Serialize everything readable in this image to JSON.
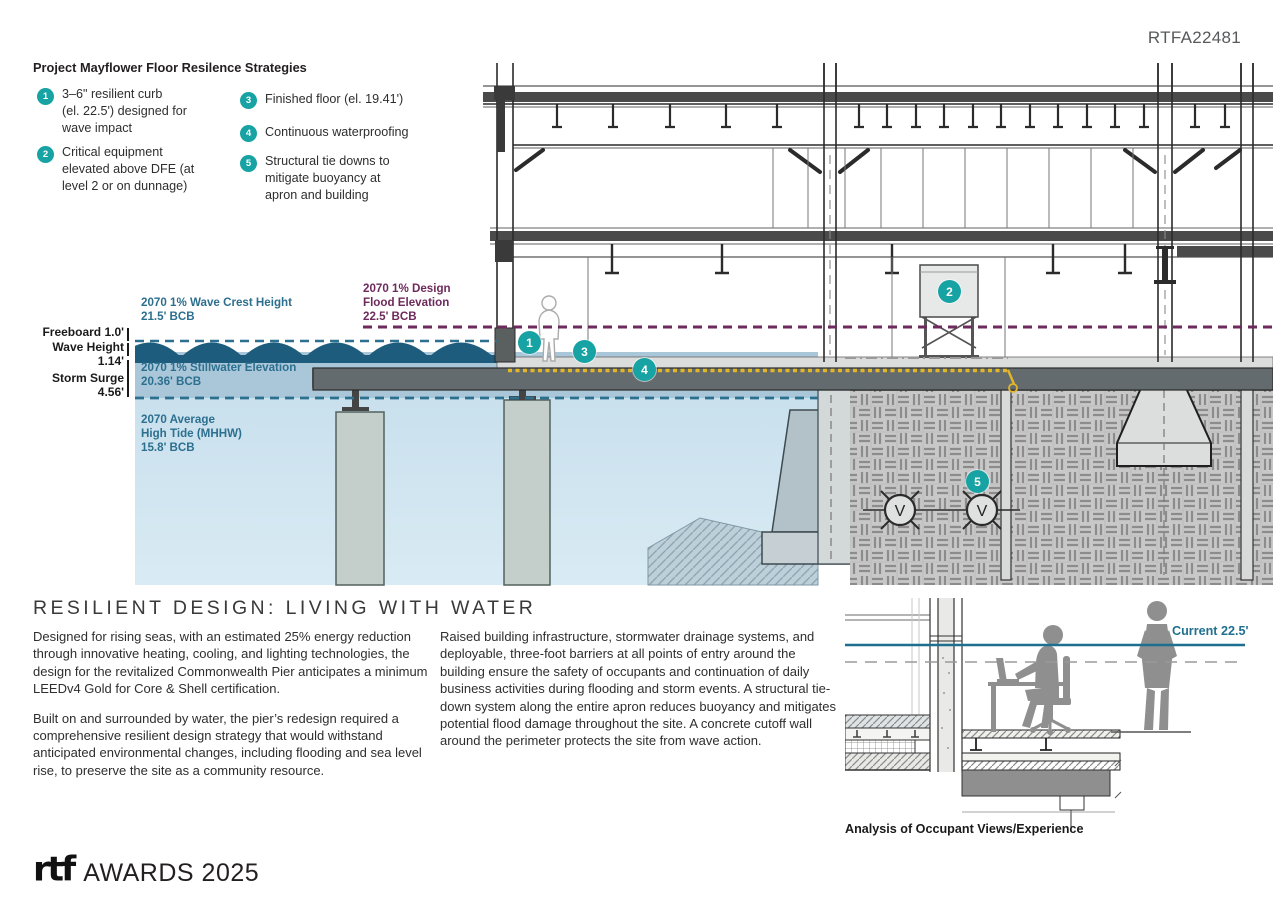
{
  "ref_number": "RTFA22481",
  "legend": {
    "title": "Project Mayflower Floor Resilence Strategies",
    "items": [
      {
        "num": "1",
        "text": "3–6\" resilient curb\n(el. 22.5') designed for\nwave impact"
      },
      {
        "num": "2",
        "text": "Critical equipment\nelevated above DFE (at\nlevel 2 or on dunnage)"
      },
      {
        "num": "3",
        "text": "Finished floor (el. 19.41')"
      },
      {
        "num": "4",
        "text": "Continuous waterproofing"
      },
      {
        "num": "5",
        "text": "Structural tie downs to\nmitigate buoyancy at\napron and building"
      }
    ]
  },
  "diagram": {
    "labels": {
      "wave_crest": "2070 1% Wave Crest Height\n21.5' BCB",
      "design_flood": "2070 1% Design\nFlood Elevation\n22.5' BCB",
      "stillwater": "2070 1% Stillwater Elevation\n20.36' BCB",
      "high_tide": "2070 Average\nHigh Tide (MHHW)\n15.8' BCB",
      "freeboard": "Freeboard 1.0'",
      "wave_height": "Wave Height 1.14'",
      "storm_surge": "Storm Surge 4.56'"
    },
    "badges": [
      "1",
      "2",
      "3",
      "4",
      "5"
    ],
    "valve_symbol": "V"
  },
  "article": {
    "heading": "RESILIENT DESIGN: LIVING WITH WATER",
    "col1_p1": "Designed for rising seas, with an estimated 25% energy reduction through innovative heating, cooling, and lighting technologies, the design for the revitalized Commonwealth Pier anticipates a minimum LEEDv4 Gold for Core & Shell certification.",
    "col1_p2": "Built on and surrounded by water, the pier’s redesign required a comprehensive resilient design strategy that would withstand anticipated environmental changes, including flooding and sea level rise, to preserve the site as a community resource.",
    "col2_p1": "Raised building infrastructure, stormwater drainage systems, and deployable, three-foot barriers at all points of entry around the building ensure the safety of occupants and continuation of daily business activities during flooding and storm events. A structural tie-down system along the entire apron reduces buoyancy and mitigates potential flood damage throughout the site. A concrete cutoff wall around the perimeter protects the site from wave action."
  },
  "detail": {
    "current_label": "Current 22.5'",
    "caption": "Analysis of Occupant Views/Experience"
  },
  "footer": {
    "logo": "rtf",
    "awards": "AWARDS 2025"
  },
  "colors": {
    "badge_teal": "#17A2A3",
    "label_teal": "#2C6F8F",
    "label_purple": "#6E2A5C",
    "wave_dark": "#1E5C7D",
    "water_medium": "#AAC7D9",
    "water_light": "#CDE3EF",
    "waterproofing_yellow": "#E2B62B",
    "slab_gray": "#5E686B"
  }
}
